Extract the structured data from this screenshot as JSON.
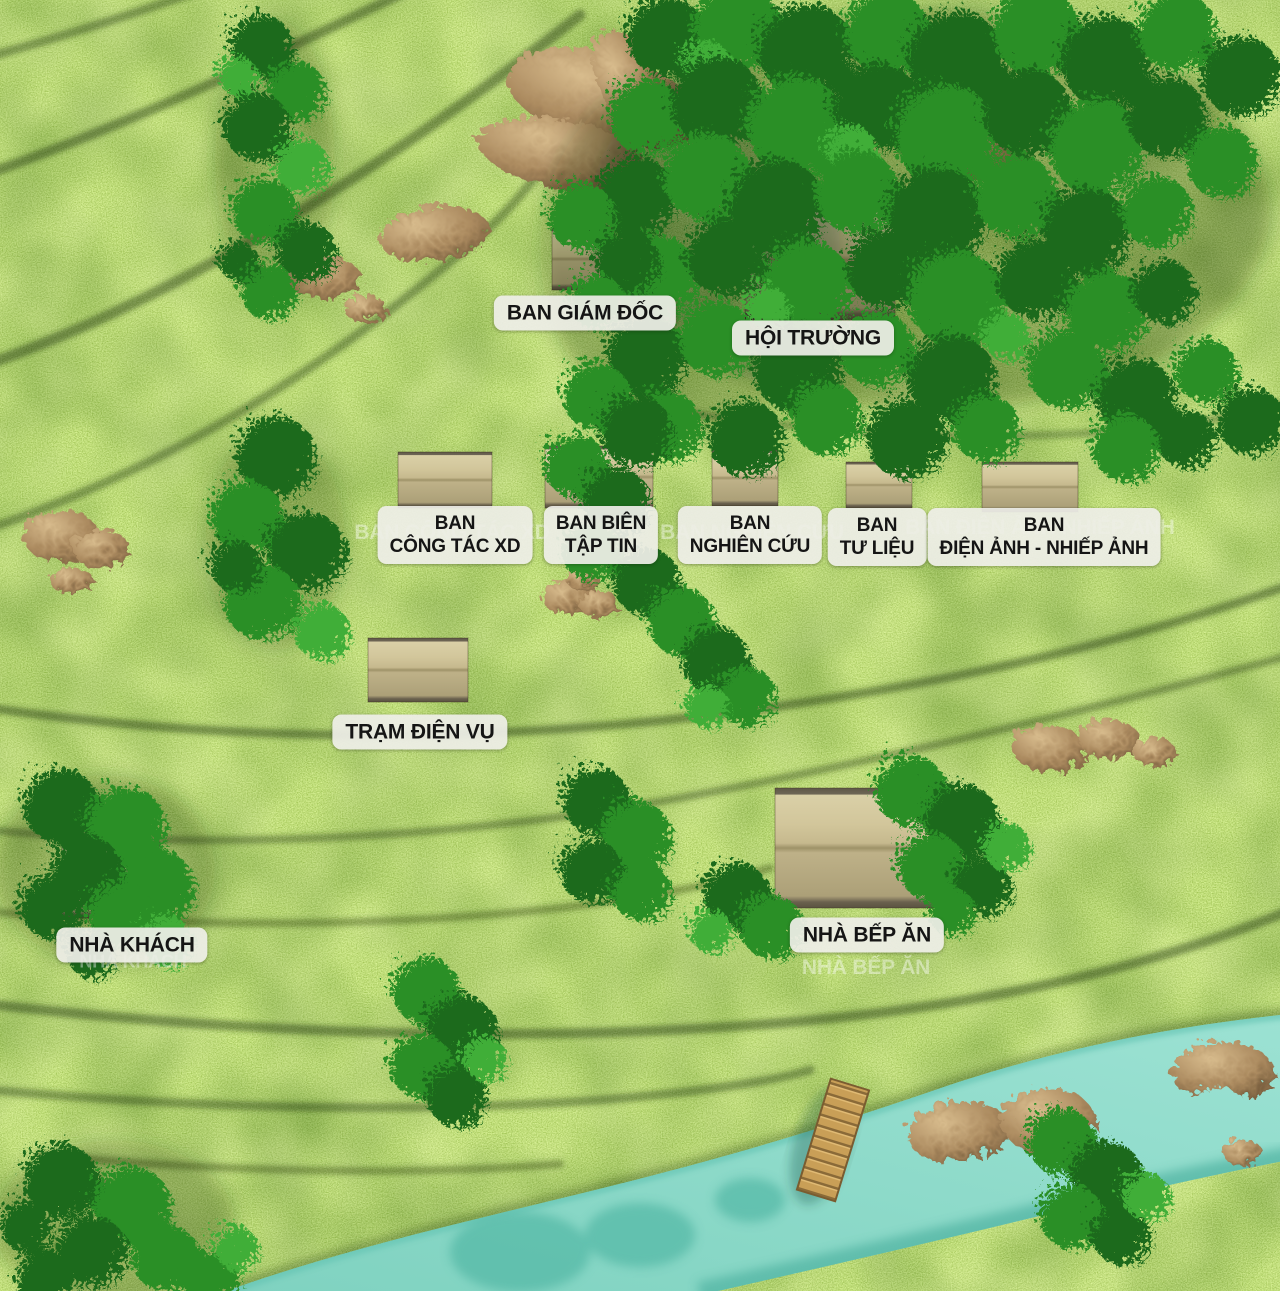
{
  "scene": {
    "type": "aerial-site-plan-3d-model",
    "features": [
      "grass-terrain",
      "contour-lines",
      "tree-clusters",
      "boulders",
      "river",
      "wooden-bridge",
      "thatched-roof-buildings"
    ]
  },
  "labels": {
    "ban_giam_doc": {
      "l1": "BAN GIÁM ĐỐC"
    },
    "hoi_truong": {
      "l1": "HỘI TRƯỜNG"
    },
    "ban_cong_tac_xd": {
      "l1": "BAN",
      "l2": "CÔNG TÁC XD"
    },
    "ban_bien_tap_tin": {
      "l1": "BAN BIÊN",
      "l2": "TẬP TIN"
    },
    "ban_nghien_cuu": {
      "l1": "BAN",
      "l2": "NGHIÊN CỨU"
    },
    "ban_tu_lieu": {
      "l1": "BAN",
      "l2": "TƯ LIỆU"
    },
    "ban_dien_anh": {
      "l1": "BAN",
      "l2": "ĐIỆN ẢNH - NHIẾP ẢNH"
    },
    "tram_dien_vu": {
      "l1": "TRẠM ĐIỆN VỤ"
    },
    "nha_khach": {
      "l1": "NHÀ KHÁCH"
    },
    "nha_bep_an": {
      "l1": "NHÀ BẾP ĂN"
    }
  },
  "ghost_labels": {
    "ban_cong_tac_xd": "BAN CÔNG TÁC XD",
    "ban_nghien_cuu": "BAN NGHIÊN CỨU",
    "ban_dien_anh": "BAN ĐIỆN ẢNH NHIẾP ẢNH",
    "nha_khach": "NHÀ KHÁCH",
    "nha_bep_an": "NHÀ BẾP ĂN"
  },
  "colors": {
    "grass_light": "#d4e57e",
    "grass_base": "#a9c95b",
    "grass_dark": "#3f5c1c",
    "tree_dark": "#1d6b1d",
    "tree_light": "#3fae37",
    "river": "#8edbcb",
    "river_shadow": "#57b7a6",
    "rock": "#ab8a5f",
    "roof_tan": "#cfc398",
    "bridge_wood": "#c99f57",
    "label_bg": "#eeeee7",
    "label_text": "#151515"
  }
}
